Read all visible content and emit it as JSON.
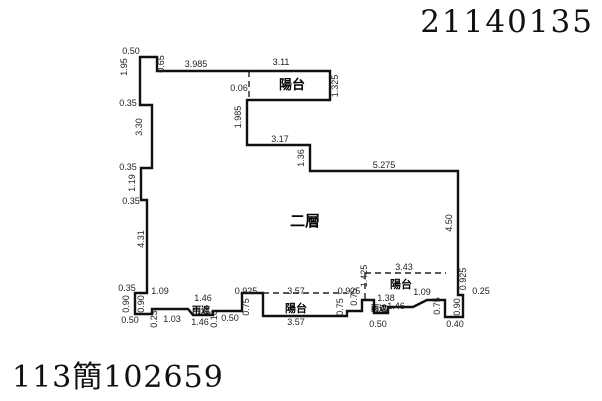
{
  "page": {
    "top_right_number": "21140135",
    "bottom_left_number": "113簡102659"
  },
  "floor_plan": {
    "line_color": "#111111",
    "outline": [
      [
        140,
        57
      ],
      [
        157,
        57
      ],
      [
        157,
        71
      ],
      [
        330,
        71
      ],
      [
        330,
        100
      ],
      [
        249,
        100
      ],
      [
        247,
        100
      ],
      [
        247,
        145
      ],
      [
        310,
        145
      ],
      [
        310,
        171
      ],
      [
        458,
        171
      ],
      [
        458,
        295
      ],
      [
        463,
        295
      ],
      [
        463,
        317
      ],
      [
        445,
        317
      ],
      [
        445,
        300
      ],
      [
        427,
        300
      ],
      [
        413,
        307
      ],
      [
        388,
        307
      ],
      [
        388,
        313
      ],
      [
        374,
        313
      ],
      [
        374,
        300
      ],
      [
        362,
        300
      ],
      [
        362,
        311
      ],
      [
        347,
        311
      ],
      [
        347,
        316
      ],
      [
        263,
        316
      ],
      [
        263,
        293
      ],
      [
        242,
        293
      ],
      [
        242,
        311
      ],
      [
        213,
        311
      ],
      [
        213,
        315
      ],
      [
        193,
        315
      ],
      [
        188,
        309
      ],
      [
        152,
        309
      ],
      [
        152,
        314
      ],
      [
        135,
        314
      ],
      [
        135,
        293
      ],
      [
        147,
        293
      ],
      [
        147,
        200
      ],
      [
        141,
        200
      ],
      [
        141,
        168
      ],
      [
        152,
        168
      ],
      [
        152,
        105
      ],
      [
        140,
        105
      ]
    ],
    "dashed_lines": [
      [
        [
          249,
          71
        ],
        [
          249,
          100
        ]
      ],
      [
        [
          263,
          293
        ],
        [
          347,
          293
        ]
      ],
      [
        [
          365,
          273
        ],
        [
          446,
          273
        ]
      ],
      [
        [
          365,
          273
        ],
        [
          365,
          299
        ]
      ]
    ],
    "area_labels": [
      {
        "text": "陽台",
        "x": 292,
        "y": 89,
        "size": 13
      },
      {
        "text": "二層",
        "x": 305,
        "y": 226,
        "size": 15
      },
      {
        "text": "陽台",
        "x": 296,
        "y": 312,
        "size": 11
      },
      {
        "text": "陽台",
        "x": 401,
        "y": 288,
        "size": 11
      },
      {
        "text": "雨遮",
        "x": 201,
        "y": 313,
        "size": 9
      },
      {
        "text": "雨遮",
        "x": 379,
        "y": 311,
        "size": 8
      }
    ],
    "dimensions": [
      {
        "text": "0.50",
        "x": 131,
        "y": 54,
        "rot": 0
      },
      {
        "text": "1.95",
        "x": 127,
        "y": 67,
        "rot": -90
      },
      {
        "text": "0.65",
        "x": 164,
        "y": 64,
        "rot": -90
      },
      {
        "text": "3.985",
        "x": 196,
        "y": 67,
        "rot": 0
      },
      {
        "text": "3.11",
        "x": 281,
        "y": 65,
        "rot": 0
      },
      {
        "text": "1.325",
        "x": 338,
        "y": 86,
        "rot": -90
      },
      {
        "text": "0.06",
        "x": 239,
        "y": 91,
        "rot": 0
      },
      {
        "text": "1.985",
        "x": 241,
        "y": 117,
        "rot": -90
      },
      {
        "text": "3.17",
        "x": 280,
        "y": 142,
        "rot": 0
      },
      {
        "text": "1.36",
        "x": 304,
        "y": 158,
        "rot": -90
      },
      {
        "text": "5.275",
        "x": 384,
        "y": 168,
        "rot": 0
      },
      {
        "text": "4.50",
        "x": 452,
        "y": 223,
        "rot": -90
      },
      {
        "text": "0.35",
        "x": 128,
        "y": 106,
        "rot": 0
      },
      {
        "text": "3.30",
        "x": 142,
        "y": 127,
        "rot": -90
      },
      {
        "text": "0.35",
        "x": 128,
        "y": 170,
        "rot": 0
      },
      {
        "text": "1.19",
        "x": 135,
        "y": 183,
        "rot": -90
      },
      {
        "text": "0.35",
        "x": 131,
        "y": 204,
        "rot": 0
      },
      {
        "text": "4.31",
        "x": 144,
        "y": 239,
        "rot": -90
      },
      {
        "text": "0.35",
        "x": 127,
        "y": 291,
        "rot": 0
      },
      {
        "text": "1.09",
        "x": 160,
        "y": 294,
        "rot": 0
      },
      {
        "text": "0.90",
        "x": 129,
        "y": 304,
        "rot": -90
      },
      {
        "text": "0.90",
        "x": 144,
        "y": 304,
        "rot": -90
      },
      {
        "text": "0.50",
        "x": 130,
        "y": 323,
        "rot": 0
      },
      {
        "text": "0.23",
        "x": 157,
        "y": 319,
        "rot": -90
      },
      {
        "text": "1.03",
        "x": 172,
        "y": 322,
        "rot": 0
      },
      {
        "text": "1.46",
        "x": 203,
        "y": 301,
        "rot": 0
      },
      {
        "text": "1.46",
        "x": 200,
        "y": 325,
        "rot": 0
      },
      {
        "text": "0.10",
        "x": 217,
        "y": 319,
        "rot": -90
      },
      {
        "text": "0.50",
        "x": 230,
        "y": 321,
        "rot": 0
      },
      {
        "text": "0.925",
        "x": 246,
        "y": 294,
        "rot": 0
      },
      {
        "text": "0.75",
        "x": 249,
        "y": 307,
        "rot": -90
      },
      {
        "text": "3.57",
        "x": 296,
        "y": 294,
        "rot": 0
      },
      {
        "text": "3.57",
        "x": 296,
        "y": 325,
        "rot": 0
      },
      {
        "text": "0.75",
        "x": 343,
        "y": 307,
        "rot": -90
      },
      {
        "text": "0.925",
        "x": 349,
        "y": 294,
        "rot": 0
      },
      {
        "text": "0.75",
        "x": 357,
        "y": 297,
        "rot": -90
      },
      {
        "text": "1.425",
        "x": 367,
        "y": 276,
        "rot": -90
      },
      {
        "text": "3.43",
        "x": 404,
        "y": 270,
        "rot": 0
      },
      {
        "text": "1.38",
        "x": 386,
        "y": 301,
        "rot": 0
      },
      {
        "text": "1.46",
        "x": 396,
        "y": 309,
        "rot": 0
      },
      {
        "text": "0.50",
        "x": 378,
        "y": 327,
        "rot": 0
      },
      {
        "text": "1.09",
        "x": 422,
        "y": 295,
        "rot": 0
      },
      {
        "text": "0.75",
        "x": 440,
        "y": 306,
        "rot": -90
      },
      {
        "text": "0.90",
        "x": 460,
        "y": 307,
        "rot": -90
      },
      {
        "text": "0.925",
        "x": 466,
        "y": 279,
        "rot": -90
      },
      {
        "text": "0.25",
        "x": 481,
        "y": 294,
        "rot": 0
      },
      {
        "text": "0.40",
        "x": 455,
        "y": 327,
        "rot": 0
      }
    ]
  }
}
